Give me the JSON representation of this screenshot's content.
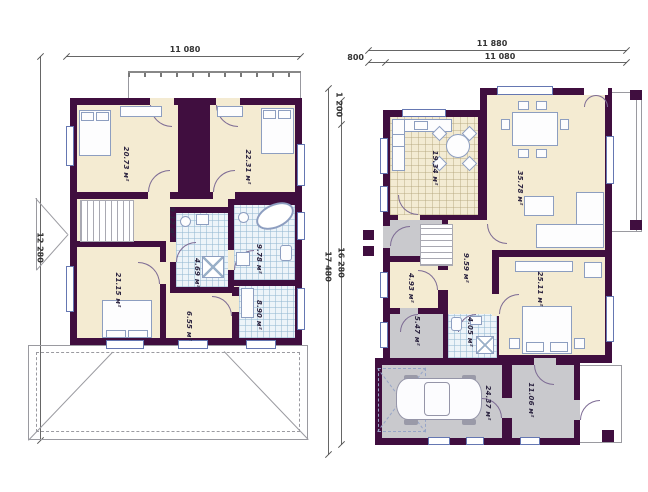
{
  "drawing": {
    "title": "two-storey house floor plans",
    "unit": "м²"
  },
  "colors": {
    "wall": "#400e3f",
    "floor": "#f4ebd2",
    "tile": "#edf4f9",
    "gray": "#c9c9cd",
    "window_frame": "#6577b2",
    "outline": "#9a9aa0",
    "dashed_blue": "#96a5c8",
    "label_text": "#2c2440",
    "dim_text": "#333333"
  },
  "left_plan": {
    "name": "second floor plan",
    "dims": {
      "top": "11 080",
      "left": "12 280"
    },
    "rooms": {
      "bedroom1": "20.73 м²",
      "bedroom2": "22.31 м²",
      "hall": "9.12 м²",
      "bedroom3": "21.15 м²",
      "wc": "4.69 м²",
      "bath": "9.78 м²",
      "wardrobe": "6.55 м²",
      "laundry": "8.90 м²"
    }
  },
  "right_plan": {
    "name": "first floor plan",
    "dims": {
      "top_outer": "11 880",
      "top_inner": "11 080",
      "top_offset": "800",
      "left_outer": "17 480",
      "left_inner": "16 280",
      "left_offset": "1 200"
    },
    "rooms": {
      "kitchen": "19.34 м²",
      "living": "35.78 м²",
      "hall": "9.59 м²",
      "pantry": "4.93 м²",
      "storage": "5.47 м²",
      "bath": "4.05 м²",
      "bedroom": "25.11 м²",
      "garage": "24.37 м²",
      "entry": "11.06 м²"
    }
  }
}
